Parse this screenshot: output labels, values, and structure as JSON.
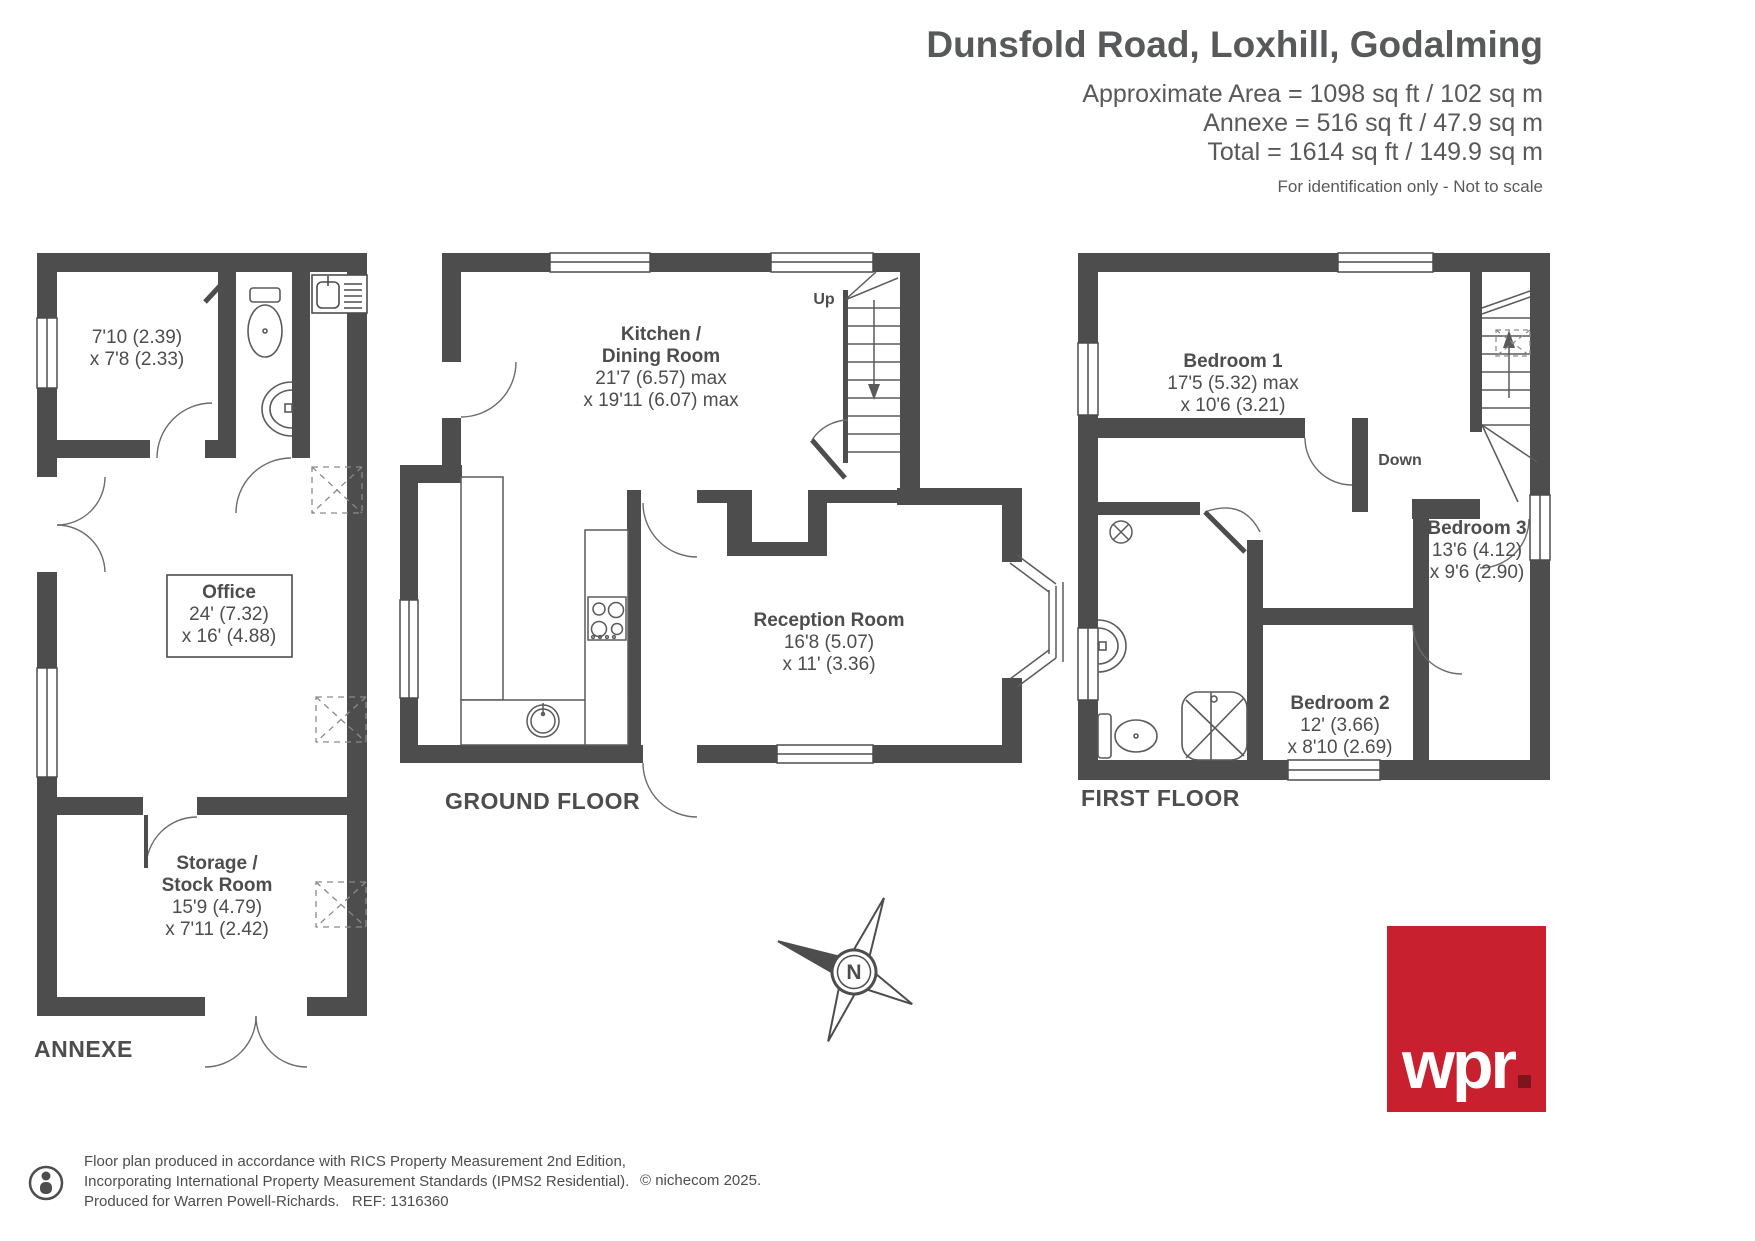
{
  "header": {
    "title": "Dunsfold Road, Loxhill, Godalming",
    "area_line1": "Approximate Area = 1098 sq ft / 102 sq m",
    "area_line2": "Annexe = 516 sq ft / 47.9 sq m",
    "area_line3": "Total = 1614 sq ft / 149.9 sq m",
    "note": "For identification only - Not to scale"
  },
  "annexe": {
    "floor_label": "ANNEXE",
    "room_top": {
      "dim1": "7'10 (2.39)",
      "dim2": "x 7'8 (2.33)"
    },
    "office": {
      "name": "Office",
      "dim1": "24' (7.32)",
      "dim2": "x 16' (4.88)"
    },
    "storage": {
      "name1": "Storage /",
      "name2": "Stock Room",
      "dim1": "15'9 (4.79)",
      "dim2": "x 7'11 (2.42)"
    }
  },
  "ground_floor": {
    "floor_label": "GROUND FLOOR",
    "up_label": "Up",
    "kitchen": {
      "name1": "Kitchen /",
      "name2": "Dining Room",
      "dim1": "21'7 (6.57) max",
      "dim2": "x 19'11 (6.07) max"
    },
    "reception": {
      "name": "Reception Room",
      "dim1": "16'8 (5.07)",
      "dim2": "x 11' (3.36)"
    }
  },
  "first_floor": {
    "floor_label": "FIRST FLOOR",
    "down_label": "Down",
    "bedroom1": {
      "name": "Bedroom 1",
      "dim1": "17'5 (5.32) max",
      "dim2": "x 10'6 (3.21)"
    },
    "bedroom2": {
      "name": "Bedroom 2",
      "dim1": "12' (3.66)",
      "dim2": "x 8'10 (2.69)"
    },
    "bedroom3": {
      "name": "Bedroom 3",
      "dim1": "13'6 (4.12)",
      "dim2": "x 9'6 (2.90)"
    }
  },
  "compass": {
    "north_label": "N"
  },
  "footer": {
    "line1": "Floor plan produced in accordance with RICS Property Measurement 2nd Edition,",
    "line2": "Incorporating International Property Measurement Standards (IPMS2 Residential).",
    "line3_part1": "Produced for Warren Powell-Richards.",
    "line3_ref": "REF: 1316360",
    "copyright": "© nichecom 2025."
  },
  "logo": {
    "text": "wpr"
  },
  "colors": {
    "wall": "#4d4d4d",
    "logo_red": "#c8202f",
    "logo_dot": "#7e141c",
    "text": "#4d4d4d"
  }
}
